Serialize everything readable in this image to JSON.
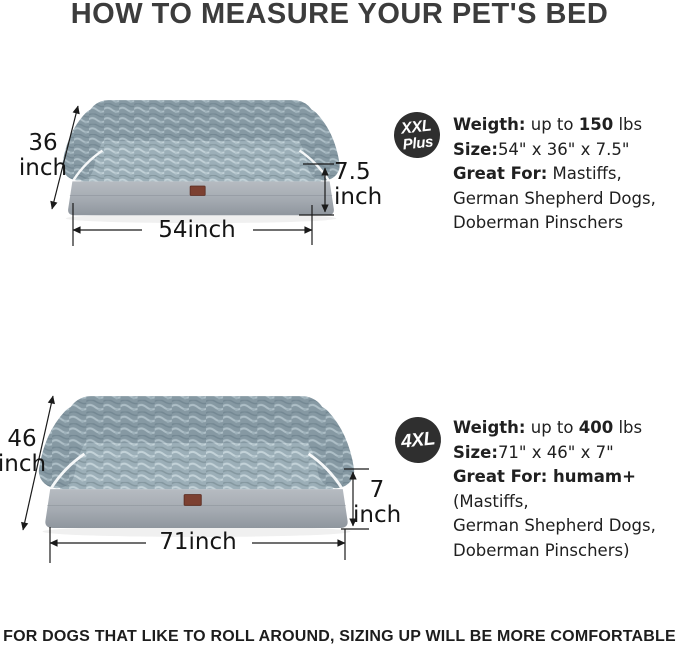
{
  "page": {
    "title": "HOW TO MEASURE YOUR PET'S BED",
    "footer": "FOR DOGS THAT LIKE TO ROLL AROUND, SIZING UP WILL BE MORE COMFORTABLE"
  },
  "colors": {
    "badge_bg": "#2f2f2f",
    "badge_text": "#ffffff",
    "plush_gray": "#8699a3",
    "plush_light": "#9cafb8",
    "base_gray": "#a6acb3",
    "piping_white": "#f6f8f9",
    "tag_brown": "#7c4031",
    "arrow_black": "#1a1a1a"
  },
  "sections": [
    {
      "badge": {
        "line1": "XXL",
        "line2": "Plus"
      },
      "dimensions": {
        "depth_value": "36",
        "depth_unit": "inch",
        "height_value": "7.5",
        "height_unit": "inch",
        "width_value": "54inch"
      },
      "specs": {
        "weight_label": "Weigth:",
        "weight_mid": " up to ",
        "weight_value": "150",
        "weight_suffix": " lbs",
        "size_label": "Size:",
        "size_value": "54\" x 36\" x 7.5\"",
        "great_label": "Great For:",
        "great_bold_extra": "",
        "great_first": " Mastiffs,",
        "great_line2": "German Shepherd Dogs,",
        "great_line3": "Doberman Pinschers"
      }
    },
    {
      "badge": {
        "line1": "4XL",
        "line2": ""
      },
      "dimensions": {
        "depth_value": "46",
        "depth_unit": "inch",
        "height_value": "7",
        "height_unit": "inch",
        "width_value": "71inch"
      },
      "specs": {
        "weight_label": "Weigth:",
        "weight_mid": " up to ",
        "weight_value": "400",
        "weight_suffix": " lbs",
        "size_label": "Size:",
        "size_value": "71\" x 46\" x 7\"",
        "great_label": "Great For:",
        "great_bold_extra": " humam+",
        "great_first": "(Mastiffs,",
        "great_line2": "German Shepherd Dogs,",
        "great_line3": "Doberman Pinschers)"
      }
    }
  ]
}
